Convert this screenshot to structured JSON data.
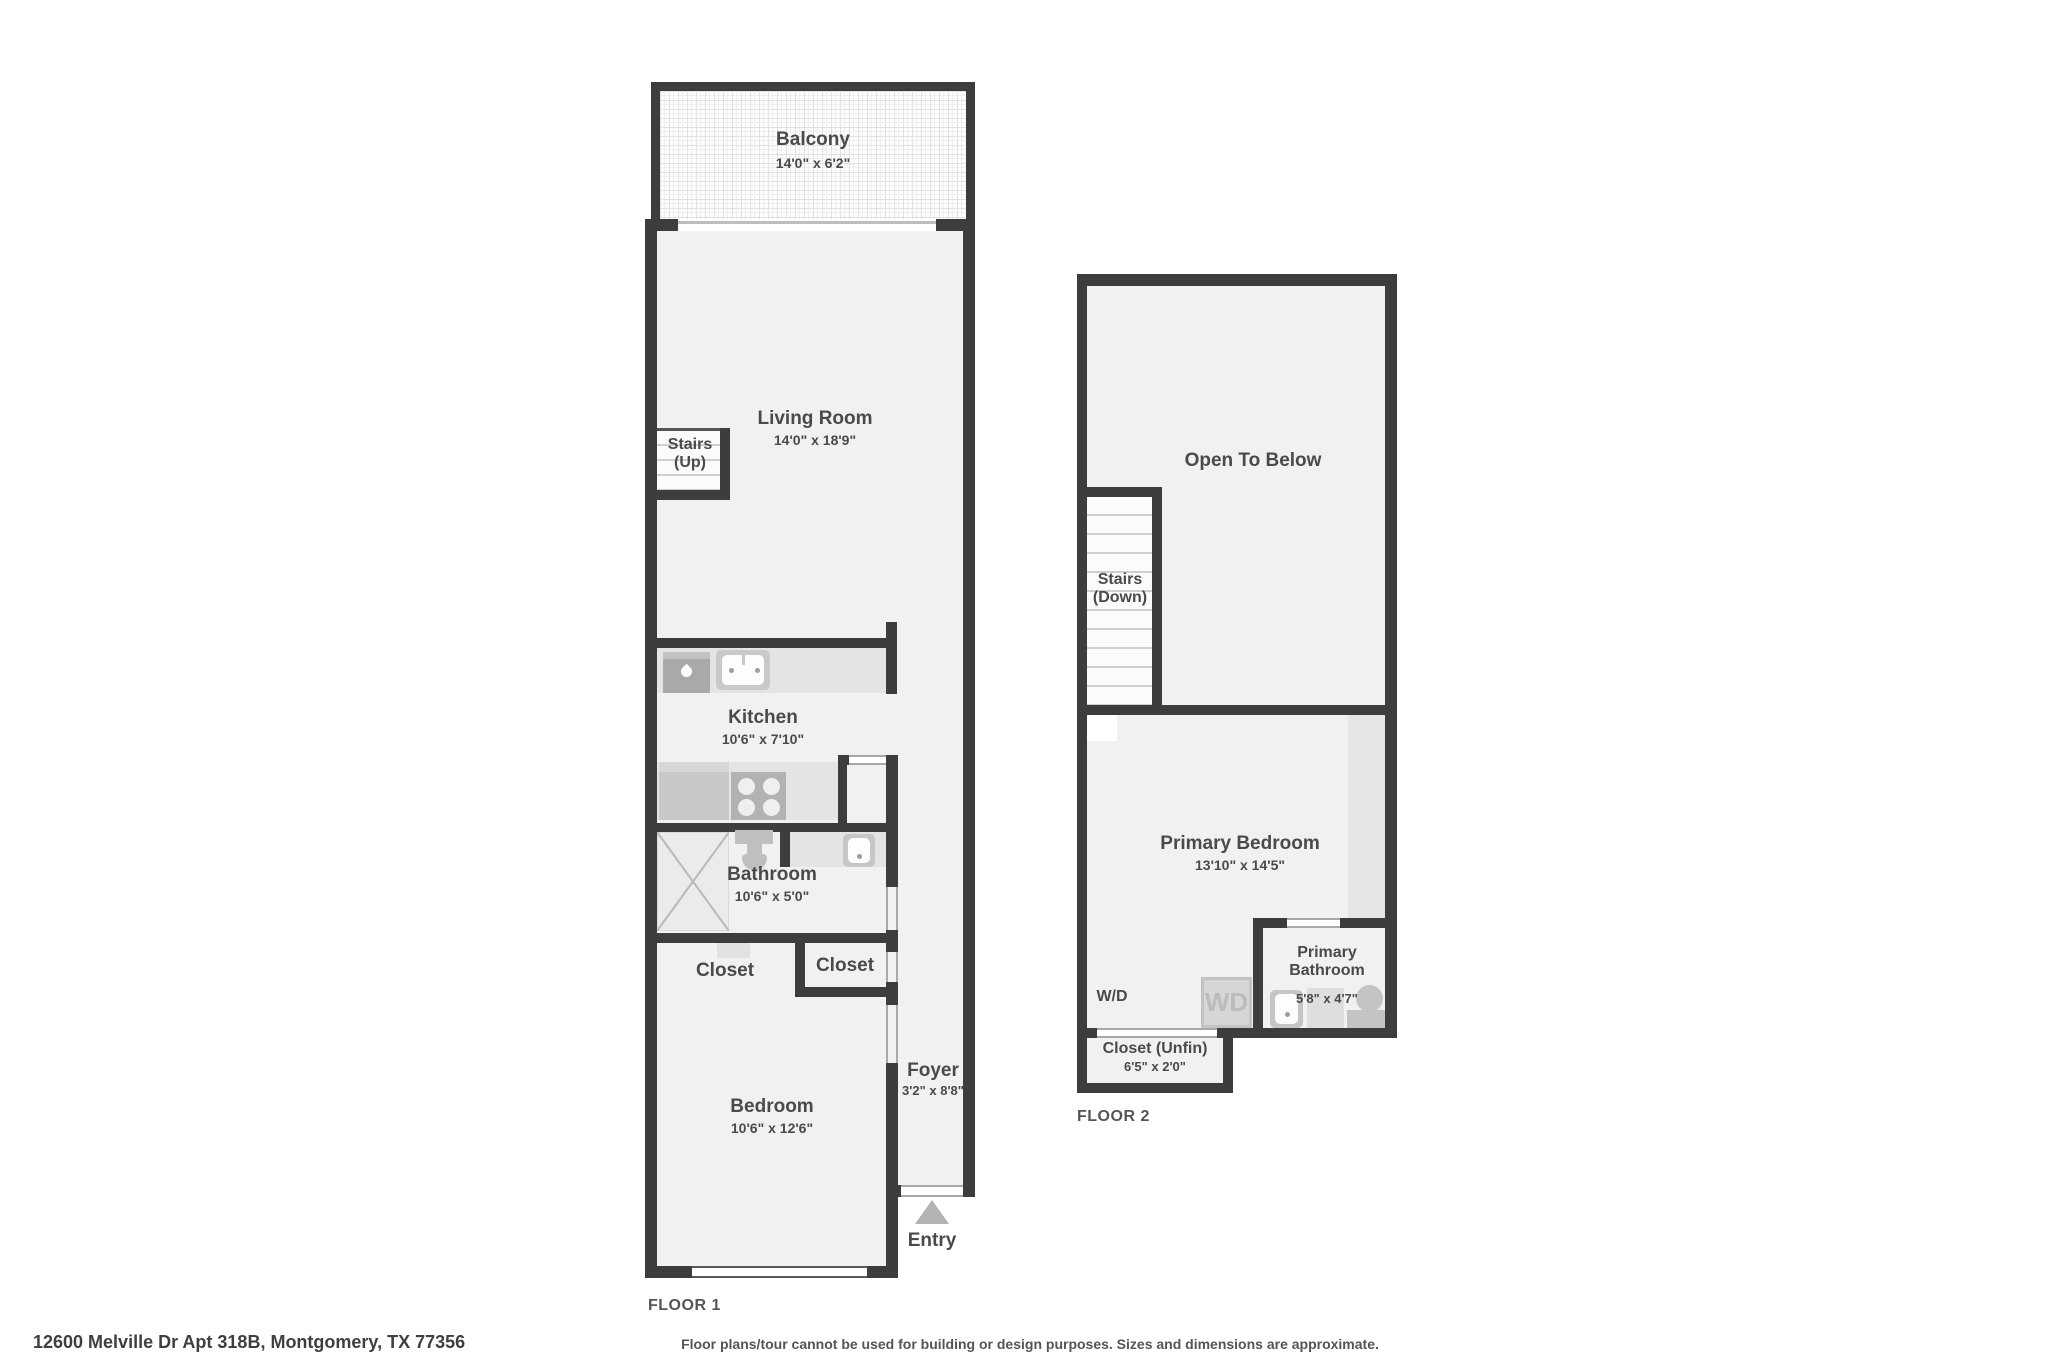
{
  "address": "12600 Melville Dr Apt 318B, Montgomery, TX 77356",
  "disclaimer": "Floor plans/tour cannot be used for building or design purposes. Sizes and dimensions are approximate.",
  "floor1": {
    "label": "FLOOR 1",
    "balcony_name": "Balcony",
    "balcony_dims": "14'0\" x 6'2\"",
    "living_name": "Living Room",
    "living_dims": "14'0\" x 18'9\"",
    "stairs_line1": "Stairs",
    "stairs_line2": "(Up)",
    "kitchen_name": "Kitchen",
    "kitchen_dims": "10'6\" x 7'10\"",
    "bathroom_name": "Bathroom",
    "bathroom_dims": "10'6\" x 5'0\"",
    "closet_a": "Closet",
    "closet_b": "Closet",
    "bedroom_name": "Bedroom",
    "bedroom_dims": "10'6\" x 12'6\"",
    "foyer_name": "Foyer",
    "foyer_dims": "3'2\" x 8'8\"",
    "entry": "Entry"
  },
  "floor2": {
    "label": "FLOOR 2",
    "open_to_below": "Open To Below",
    "stairs_line1": "Stairs",
    "stairs_line2": "(Down)",
    "primary_bedroom_name": "Primary Bedroom",
    "primary_bedroom_dims": "13'10\" x 14'5\"",
    "wd_label": "W/D",
    "wd_unit": "WD",
    "primary_bathroom_line1": "Primary",
    "primary_bathroom_line2": "Bathroom",
    "primary_bathroom_dims": "5'8\" x 4'7\"",
    "closet_unfin_name": "Closet (Unfin)",
    "closet_unfin_dims": "6'5\" x 2'0\""
  },
  "colors": {
    "wall": "#3d3d3d",
    "room_fill": "#f1f1f1",
    "counter": "#e4e4e4",
    "fixture": "#c4c4c4",
    "text": "#4a4a4a"
  }
}
